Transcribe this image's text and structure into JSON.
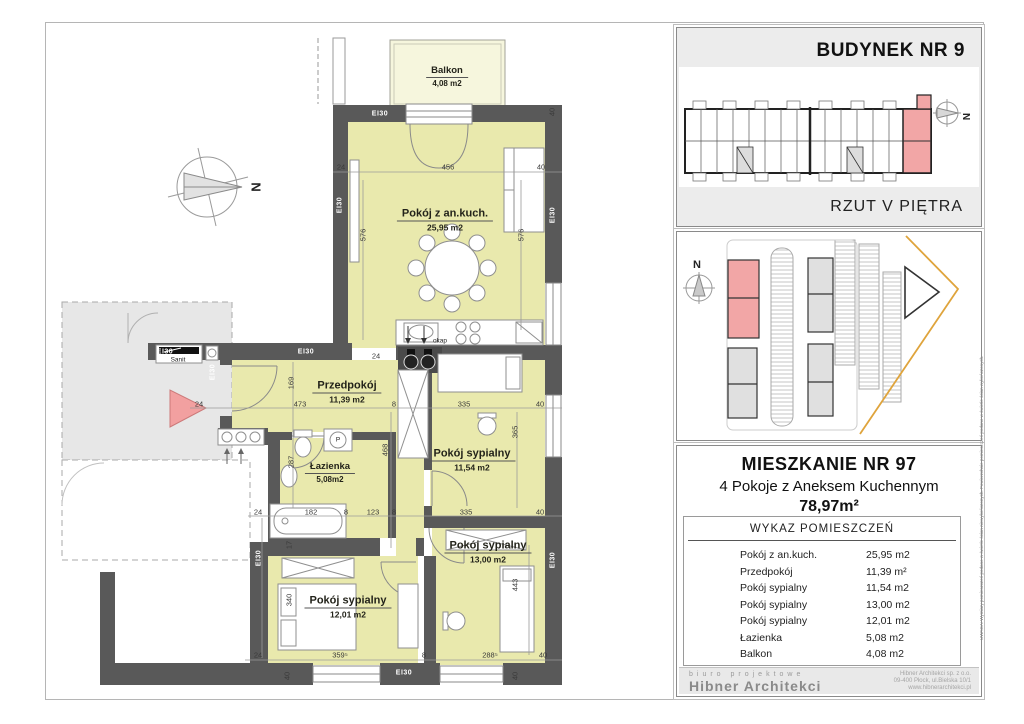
{
  "colors": {
    "wall": "#595959",
    "room_fill": "#e9e9ad",
    "balcony_fill": "#f6f6dd",
    "corridor_fill": "#e7e7e7",
    "highlight_pink": "#f2a6a6",
    "boundary_orange": "#dfa43c"
  },
  "plan": {
    "compass": "N",
    "rooms": [
      {
        "name": "Balkon",
        "area": "4,08 m2",
        "x": 447,
        "y": 74,
        "sm": true
      },
      {
        "name": "Pokój z an.kuch.",
        "area": "25,95 m2",
        "x": 445,
        "y": 218
      },
      {
        "name": "Przedpokój",
        "area": "11,39 m2",
        "x": 347,
        "y": 390
      },
      {
        "name": "Łazienka",
        "area": "5,08m2",
        "x": 330,
        "y": 470,
        "sm": true
      },
      {
        "name": "Pokój sypialny",
        "area": "11,54 m2",
        "x": 472,
        "y": 458
      },
      {
        "name": "Pokój sypialny",
        "area": "13,00 m2",
        "x": 488,
        "y": 550
      },
      {
        "name": "Pokój sypialny",
        "area": "12,01 m2",
        "x": 348,
        "y": 605
      }
    ],
    "dims": [
      {
        "t": "24",
        "x": 341,
        "y": 167,
        "r": 0
      },
      {
        "t": "456",
        "x": 448,
        "y": 167,
        "r": 0
      },
      {
        "t": "40",
        "x": 541,
        "y": 167,
        "r": 0
      },
      {
        "t": "40",
        "x": 552,
        "y": 112,
        "r": 90
      },
      {
        "t": "576",
        "x": 363,
        "y": 235,
        "r": 90
      },
      {
        "t": "576",
        "x": 521,
        "y": 235,
        "r": 90
      },
      {
        "t": "24",
        "x": 376,
        "y": 356,
        "r": 0
      },
      {
        "t": "24",
        "x": 199,
        "y": 404,
        "r": 0
      },
      {
        "t": "473",
        "x": 300,
        "y": 404,
        "r": 0
      },
      {
        "t": "8",
        "x": 394,
        "y": 404,
        "r": 0
      },
      {
        "t": "335",
        "x": 464,
        "y": 404,
        "r": 0
      },
      {
        "t": "40",
        "x": 540,
        "y": 404,
        "r": 0
      },
      {
        "t": "169",
        "x": 291,
        "y": 383,
        "r": 90
      },
      {
        "t": "287",
        "x": 291,
        "y": 462,
        "r": 90
      },
      {
        "t": "468",
        "x": 385,
        "y": 450,
        "r": 90
      },
      {
        "t": "365",
        "x": 515,
        "y": 432,
        "r": 90
      },
      {
        "t": "24",
        "x": 258,
        "y": 512,
        "r": 0
      },
      {
        "t": "182",
        "x": 311,
        "y": 512,
        "r": 0
      },
      {
        "t": "8",
        "x": 346,
        "y": 512,
        "r": 0
      },
      {
        "t": "123",
        "x": 373,
        "y": 512,
        "r": 0
      },
      {
        "t": "8",
        "x": 394,
        "y": 512,
        "r": 0
      },
      {
        "t": "335",
        "x": 466,
        "y": 512,
        "r": 0
      },
      {
        "t": "40",
        "x": 540,
        "y": 512,
        "r": 0
      },
      {
        "t": "17",
        "x": 289,
        "y": 545,
        "r": 90
      },
      {
        "t": "340",
        "x": 289,
        "y": 600,
        "r": 90
      },
      {
        "t": "443",
        "x": 515,
        "y": 585,
        "r": 90
      },
      {
        "t": "24",
        "x": 258,
        "y": 655,
        "r": 0
      },
      {
        "t": "359⁵",
        "x": 340,
        "y": 655,
        "r": 0
      },
      {
        "t": "8",
        "x": 424,
        "y": 655,
        "r": 0
      },
      {
        "t": "288⁵",
        "x": 490,
        "y": 655,
        "r": 0
      },
      {
        "t": "40",
        "x": 543,
        "y": 655,
        "r": 0
      },
      {
        "t": "40",
        "x": 287,
        "y": 676,
        "r": 90
      },
      {
        "t": "40",
        "x": 515,
        "y": 676,
        "r": 90
      }
    ],
    "wall_labels": [
      {
        "t": "EI30",
        "x": 380,
        "y": 114,
        "r": 0
      },
      {
        "t": "EI30",
        "x": 340,
        "y": 205,
        "r": 90
      },
      {
        "t": "EI30",
        "x": 553,
        "y": 215,
        "r": 90
      },
      {
        "t": "EI30",
        "x": 165,
        "y": 352,
        "r": 0
      },
      {
        "t": "EI30",
        "x": 306,
        "y": 352,
        "r": 0
      },
      {
        "t": "EI30",
        "x": 213,
        "y": 372,
        "r": 90
      },
      {
        "t": "EI30",
        "x": 259,
        "y": 558,
        "r": 90
      },
      {
        "t": "EI30",
        "x": 553,
        "y": 560,
        "r": 90
      },
      {
        "t": "EI30",
        "x": 404,
        "y": 673,
        "r": 0
      }
    ],
    "misc_labels": [
      {
        "t": "okap",
        "x": 440,
        "y": 341,
        "r": 0,
        "c": ""
      },
      {
        "t": "Sanit",
        "x": 178,
        "y": 360,
        "r": 0,
        "c": ""
      },
      {
        "t": "P",
        "x": 338,
        "y": 440,
        "r": 0,
        "c": ""
      },
      {
        "t": "N",
        "x": 256,
        "y": 187,
        "r": 90,
        "c": "compass-n"
      }
    ]
  },
  "panel": {
    "building": {
      "title": "BUDYNEK NR 9",
      "caption": "RZUT V PIĘTRA",
      "compass": "N"
    },
    "site": {
      "compass": "N"
    },
    "apartment": {
      "title": "MIESZKANIE NR 97",
      "subtitle": "4 Pokoje z Aneksem Kuchennym",
      "area": "78,97m²",
      "table_title": "WYKAZ POMIESZCZEŃ",
      "rows": [
        {
          "name": "Pokój z an.kuch.",
          "area": "25,95 m2"
        },
        {
          "name": "Przedpokój",
          "area": "11,39 m²"
        },
        {
          "name": "Pokój sypialny",
          "area": "11,54 m2"
        },
        {
          "name": "Pokój sypialny",
          "area": "13,00 m2"
        },
        {
          "name": "Pokój sypialny",
          "area": "12,01 m2"
        },
        {
          "name": "Łazienka",
          "area": "5,08 m2"
        },
        {
          "name": "Balkon",
          "area": "4,08 m2"
        }
      ],
      "note": "UWAGA: Wymiary pomieszczeń podano w świetle ścian niewykończonych. Powierzchnie pomieszczeń podano w świetle ścian wykończonych."
    },
    "footer": {
      "tagline": "biuro projektowe",
      "company": "Hibner Architekci",
      "address_lines": [
        "Hibner Architekci sp. z o.o.",
        "09-400 Płock, ul.Bielska 10/1",
        "www.hibnerarchitekci.pl"
      ]
    }
  }
}
